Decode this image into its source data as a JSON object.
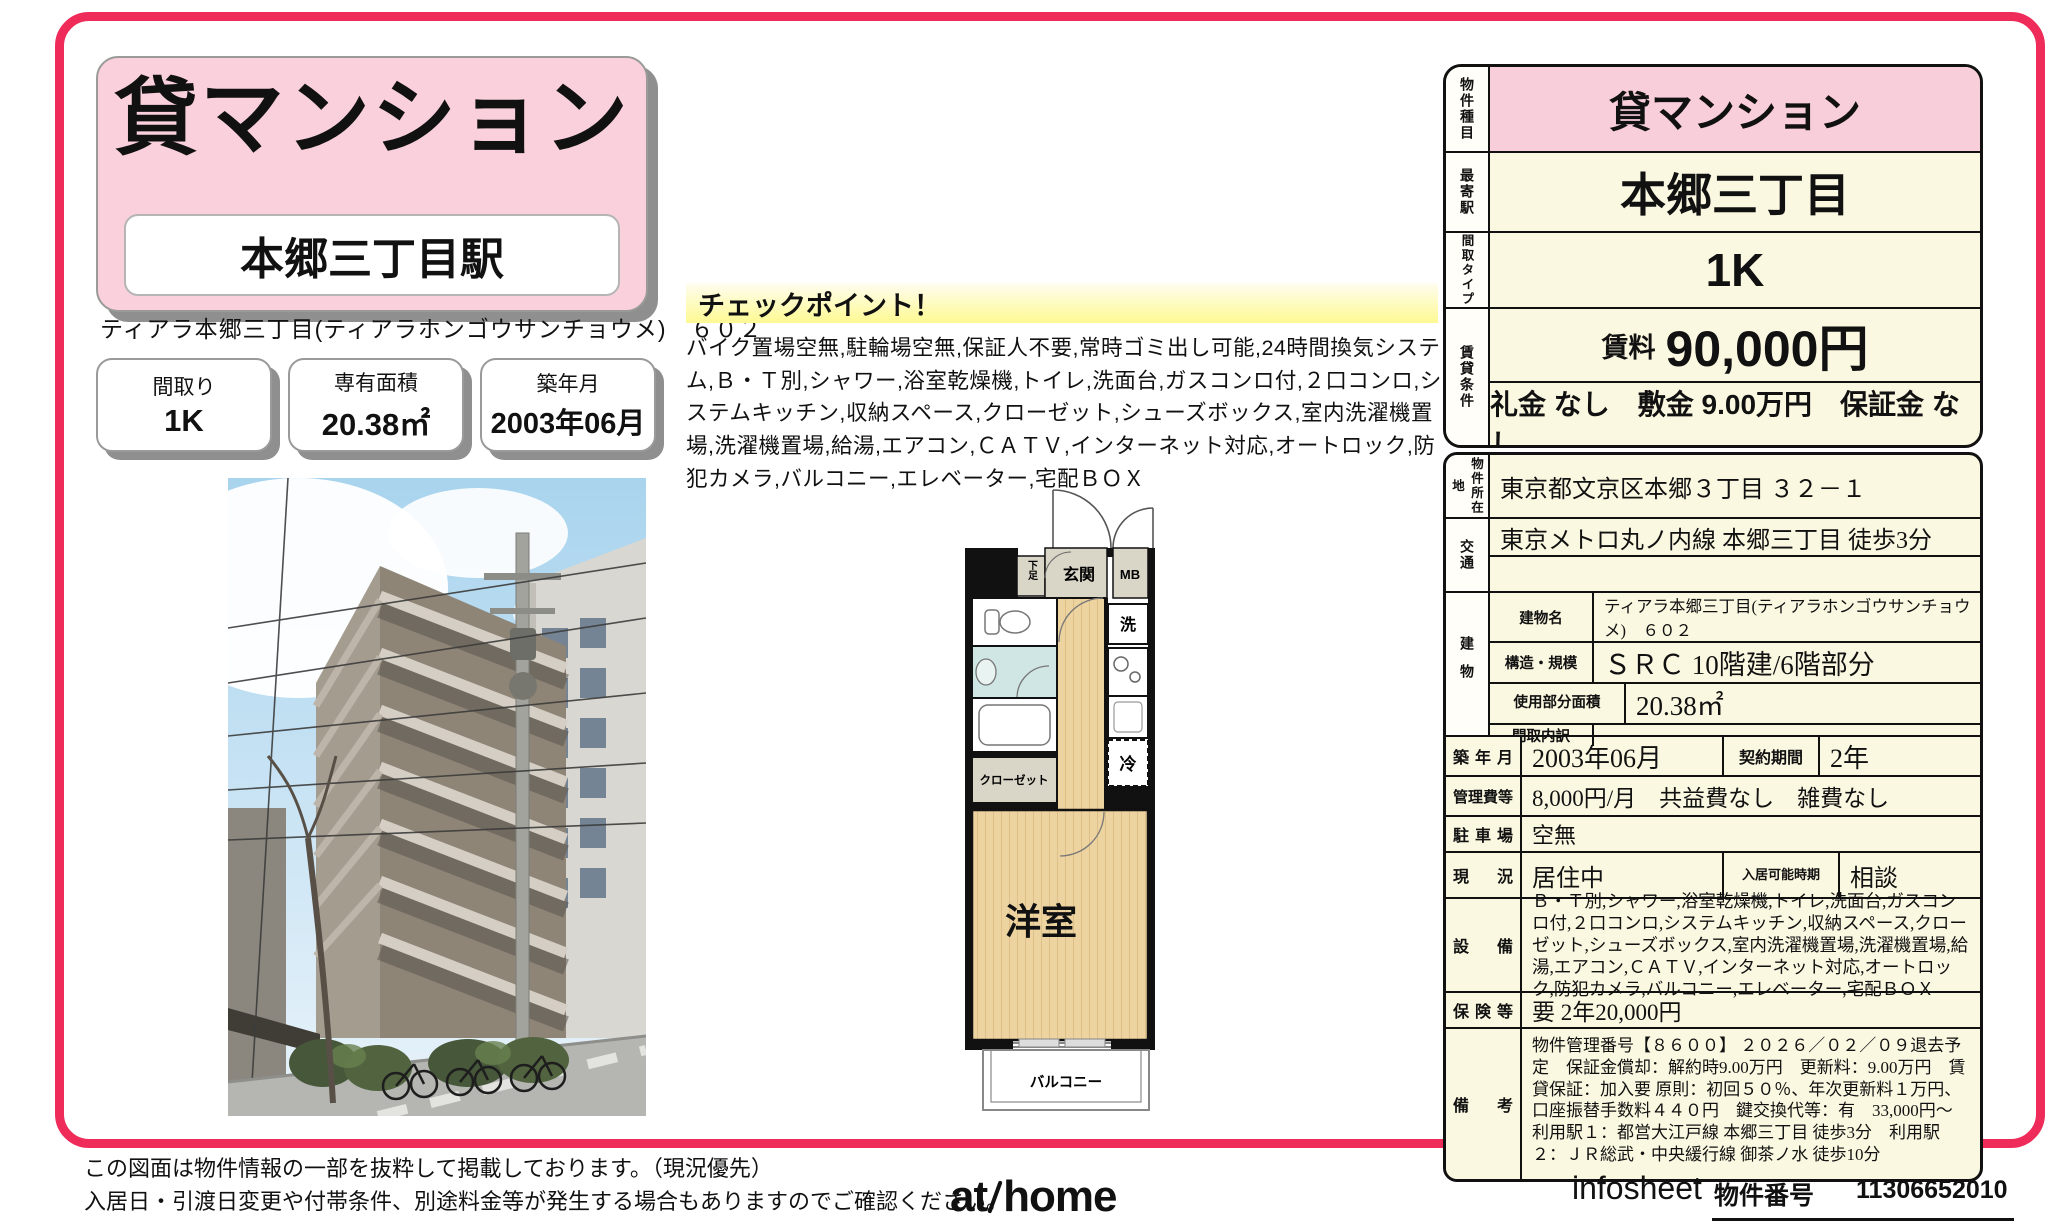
{
  "title_box": {
    "property_type": "貸マンション",
    "station": "本郷三丁目駅"
  },
  "property_name": "ティアラ本郷三丁目(ティアラホンゴウサンチョウメ)　６０２",
  "badges": [
    {
      "label": "間取り",
      "value": "1K"
    },
    {
      "label": "専有面積",
      "value": "20.38㎡"
    },
    {
      "label": "築年月",
      "value": "2003年06月"
    }
  ],
  "checkpoint": {
    "title": "チェックポイント！",
    "body": "バイク置場空無,駐輪場空無,保証人不要,常時ゴミ出し可能,24時間換気システム,Ｂ・Ｔ別,シャワー,浴室乾燥機,トイレ,洗面台,ガスコンロ付,２口コンロ,システムキッチン,収納スペース,クローゼット,シューズボックス,室内洗濯機置場,洗濯機置場,給湯,エアコン,ＣＡＴＶ,インターネット対応,オートロック,防犯カメラ,バルコニー,エレベーター,宅配ＢＯＸ"
  },
  "floorplan": {
    "entrance": "玄関",
    "shoe_box": "下足",
    "meter_box": "MB",
    "washer": "洗",
    "fridge": "冷",
    "closet": "クローゼット",
    "room": "洋室",
    "balcony": "バルコニー"
  },
  "summary": {
    "rows": [
      {
        "label": "物件種目",
        "value": "貸マンション"
      },
      {
        "label": "最寄駅",
        "value": "本郷三丁目"
      },
      {
        "label": "間取タイプ",
        "value": "1K"
      }
    ],
    "rent": {
      "label": "賃貸条件",
      "rent_label": "賃料",
      "rent_value": "90,000円",
      "terms": "礼金 なし　敷金 9.00万円　保証金 なし"
    }
  },
  "details": {
    "location": {
      "label": "物件所在地",
      "value": "東京都文京区本郷３丁目 ３２－１"
    },
    "access": {
      "label": "交通",
      "value": "東京メトロ丸ノ内線 本郷三丁目 徒歩3分"
    },
    "building": {
      "label": "建物",
      "rows": [
        {
          "label": "建物名",
          "value": "ティアラ本郷三丁目(ティアラホンゴウサンチョウメ)　６０２"
        },
        {
          "label": "構造・規模",
          "value": "ＳＲＣ 10階建/6階部分"
        },
        {
          "label": "使用部分面積",
          "value": "20.38㎡"
        },
        {
          "label": "間取内訳",
          "value": ""
        }
      ]
    },
    "built": {
      "label": "築年月",
      "value": "2003年06月",
      "label2": "契約期間",
      "value2": "2年"
    },
    "fees": {
      "label": "管理費等",
      "value": "8,000円/月　共益費なし　雑費なし"
    },
    "parking": {
      "label": "駐車場",
      "value": "空無"
    },
    "status": {
      "label": "現況",
      "value": "居住中",
      "label2": "入居可能時期",
      "value2": "相談"
    },
    "equipment": {
      "label": "設備",
      "value": "Ｂ・Ｔ別,シャワー,浴室乾燥機,トイレ,洗面台,ガスコンロ付,２口コンロ,システムキッチン,収納スペース,クローゼット,シューズボックス,室内洗濯機置場,洗濯機置場,給湯,エアコン,ＣＡＴＶ,インターネット対応,オートロック,防犯カメラ,バルコニー,エレベーター,宅配ＢＯＸ"
    },
    "insurance": {
      "label": "保険等",
      "value": "要 2年20,000円"
    },
    "notes": {
      "label": "備考",
      "value": "物件管理番号【８６００】 ２０２６／０２／０９退去予定　保証金償却：解約時9.00万円　更新料：9.00万円　賃貸保証：加入要 原則：初回５０％、年次更新料１万円、口座振替手数料４４０円　鍵交換代等：有　33,000円～　利用駅１：都営大江戸線 本郷三丁目 徒歩3分　利用駅２：ＪＲ総武・中央緩行線 御茶ノ水 徒歩10分"
    }
  },
  "footer": {
    "disclaimer1": "この図面は物件情報の一部を抜粋して掲載しております。（現況優先）",
    "disclaimer2": "入居日・引渡日変更や付帯条件、別途料金等が発生する場合もありますのでご確認ください。",
    "logo_at": "at",
    "logo_home": "home",
    "sheet_name": "infosheet",
    "property_no_label": "物件番号",
    "property_no": "11306652010"
  }
}
